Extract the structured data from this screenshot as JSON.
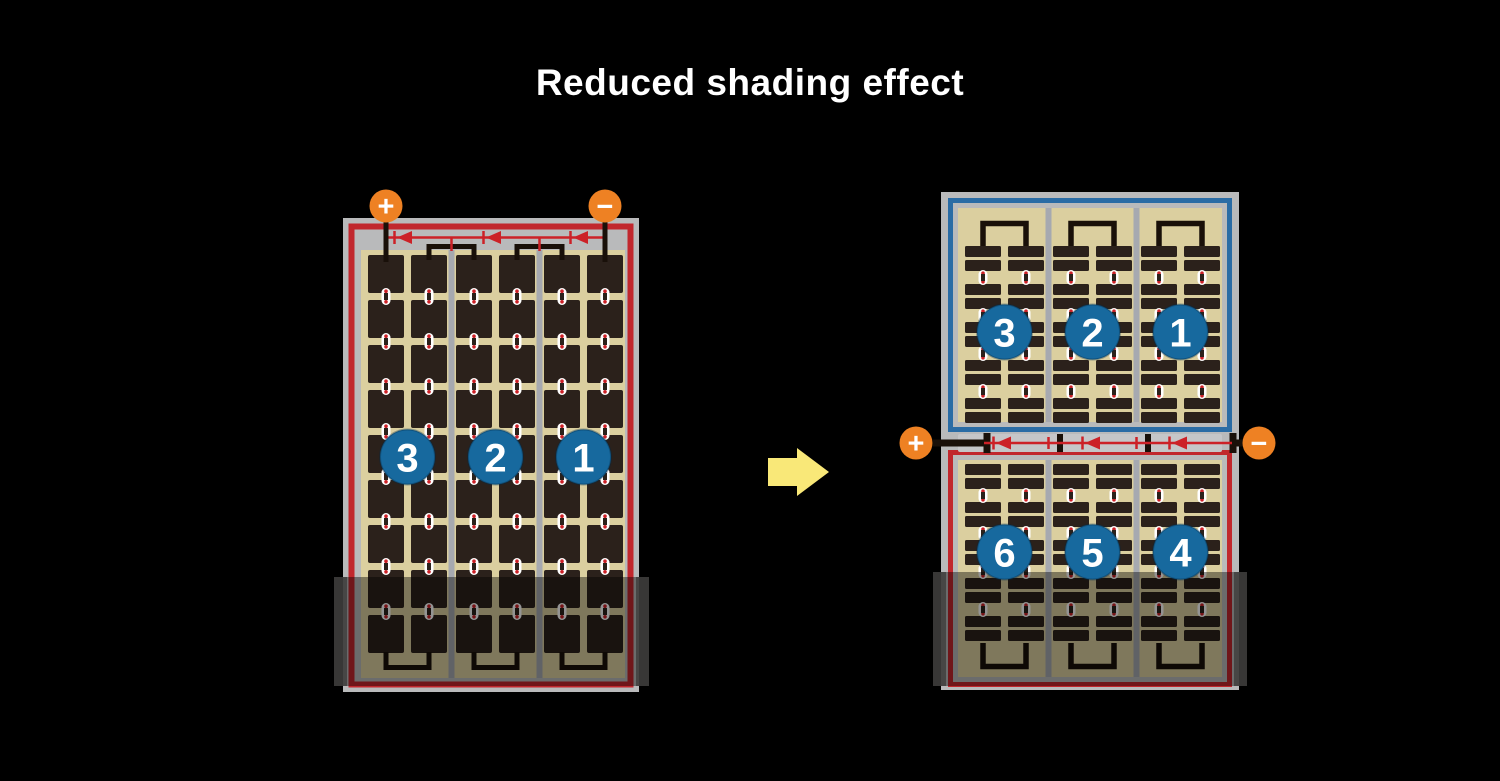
{
  "title": "Reduced shading effect",
  "colors": {
    "background": "#000000",
    "frame_gray": "#b9babb",
    "separator_gray": "#a6a9b0",
    "cell_background_tan": "#dbcf9f",
    "cell_dark": "#2b211b",
    "wire_black": "#191009",
    "red_border": "#c1272d",
    "diode_red": "#cc2127",
    "blue_border": "#2a6ca5",
    "string_badge_blue": "#17699e",
    "terminal_orange": "#ee8123",
    "arrow_yellow": "#f9e878",
    "white": "#ffffff",
    "junction_strip_gray": "#c5c6c8",
    "shade": "rgba(0,0,0,0.42)",
    "shade_cap": "#3d3c3b"
  },
  "left_module": {
    "terminals": {
      "positive_label": "+",
      "negative_label": "−"
    },
    "string_badges": [
      {
        "label": "3"
      },
      {
        "label": "2"
      },
      {
        "label": "1"
      }
    ],
    "bypass_diode_icons": 3,
    "shaded_region": true
  },
  "arrow": {
    "direction": "right"
  },
  "right_module": {
    "terminals": {
      "positive_label": "+",
      "negative_label": "−"
    },
    "top_string_badges": [
      {
        "label": "3"
      },
      {
        "label": "2"
      },
      {
        "label": "1"
      }
    ],
    "bottom_string_badges": [
      {
        "label": "6"
      },
      {
        "label": "5"
      },
      {
        "label": "4"
      }
    ],
    "bypass_diode_icons": 3,
    "shaded_region": true
  }
}
